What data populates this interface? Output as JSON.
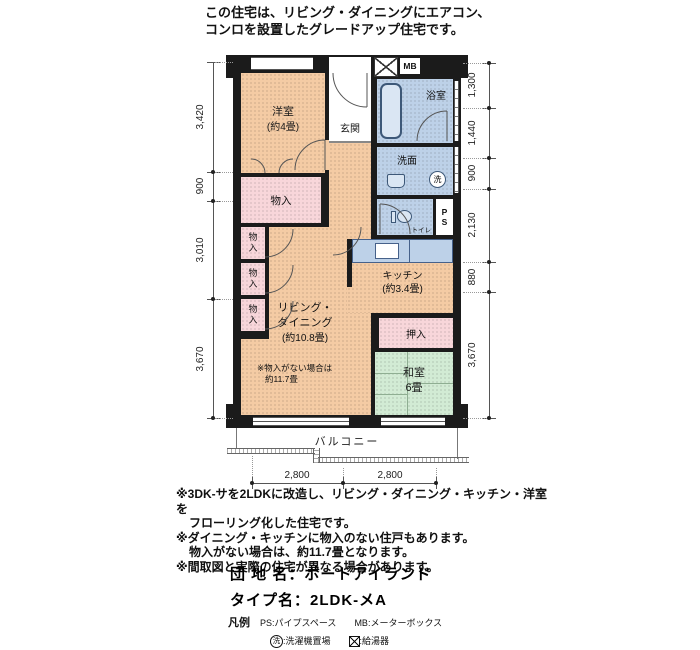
{
  "header": {
    "line1": "この住宅は、リビング・ダイニングにエアコン、",
    "line2": "コンロを設置したグレードアップ住宅です。"
  },
  "rooms": {
    "yoshitsu": {
      "name": "洋室",
      "size": "(約4畳)"
    },
    "genkan": {
      "name": "玄関"
    },
    "yokushitsu": {
      "name": "浴室"
    },
    "senmen": {
      "name": "洗面"
    },
    "toilet": {
      "name": "トイレ"
    },
    "ps": {
      "line1": "P",
      "line2": "S"
    },
    "mb": {
      "name": "MB"
    },
    "monoire_large": {
      "name": "物入"
    },
    "monoire_small": [
      "物入",
      "物入",
      "物入"
    ],
    "kitchen": {
      "name": "キッチン",
      "size": "(約3.4畳)"
    },
    "oshiire": {
      "name": "押入"
    },
    "washitsu": {
      "name": "和室",
      "size": "6畳"
    },
    "living": {
      "name1": "リビング・",
      "name2": "ダイニング",
      "size": "(約10.8畳)",
      "note1": "※物入がない場合は",
      "note2": "約11.7畳"
    },
    "laundry_symbol": "洗",
    "balcony": {
      "name": "バルコニー"
    }
  },
  "dimensions": {
    "left": [
      "3,420",
      "900",
      "3,010",
      "3,670"
    ],
    "right": [
      "1,300",
      "1,440",
      "900",
      "2,130",
      "880",
      "3,670"
    ],
    "bottom": [
      "2,800",
      "2,800"
    ]
  },
  "footnotes": [
    "※3DK-サを2LDKに改造し、リビング・ダイニング・キッチン・洋室を",
    "フローリング化した住宅です。",
    "※ダイニング・キッチンに物入のない住戸もあります。",
    "物入がない場合は、約11.7畳となります。",
    "※間取図と実際の住宅が異なる場合があります。"
  ],
  "title_block": {
    "estate_label": "団 地 名：",
    "estate_value": "ポートアイランド",
    "type_label": "タイプ名：",
    "type_value": "2LDK-メA"
  },
  "legend": {
    "heading": "凡例",
    "ps": "PS:パイプスペース",
    "mb": "MB:メーターボックス",
    "laundry_symbol": "洗",
    "laundry": ":洗濯機置場",
    "heater": ":給湯器"
  },
  "colors": {
    "room_peach": "#f4cba4",
    "closet_pink": "#f8d6da",
    "wet_blue": "#bdd1e8",
    "tatami_green": "#d2ebd4",
    "wall": "#1b1b1b"
  }
}
